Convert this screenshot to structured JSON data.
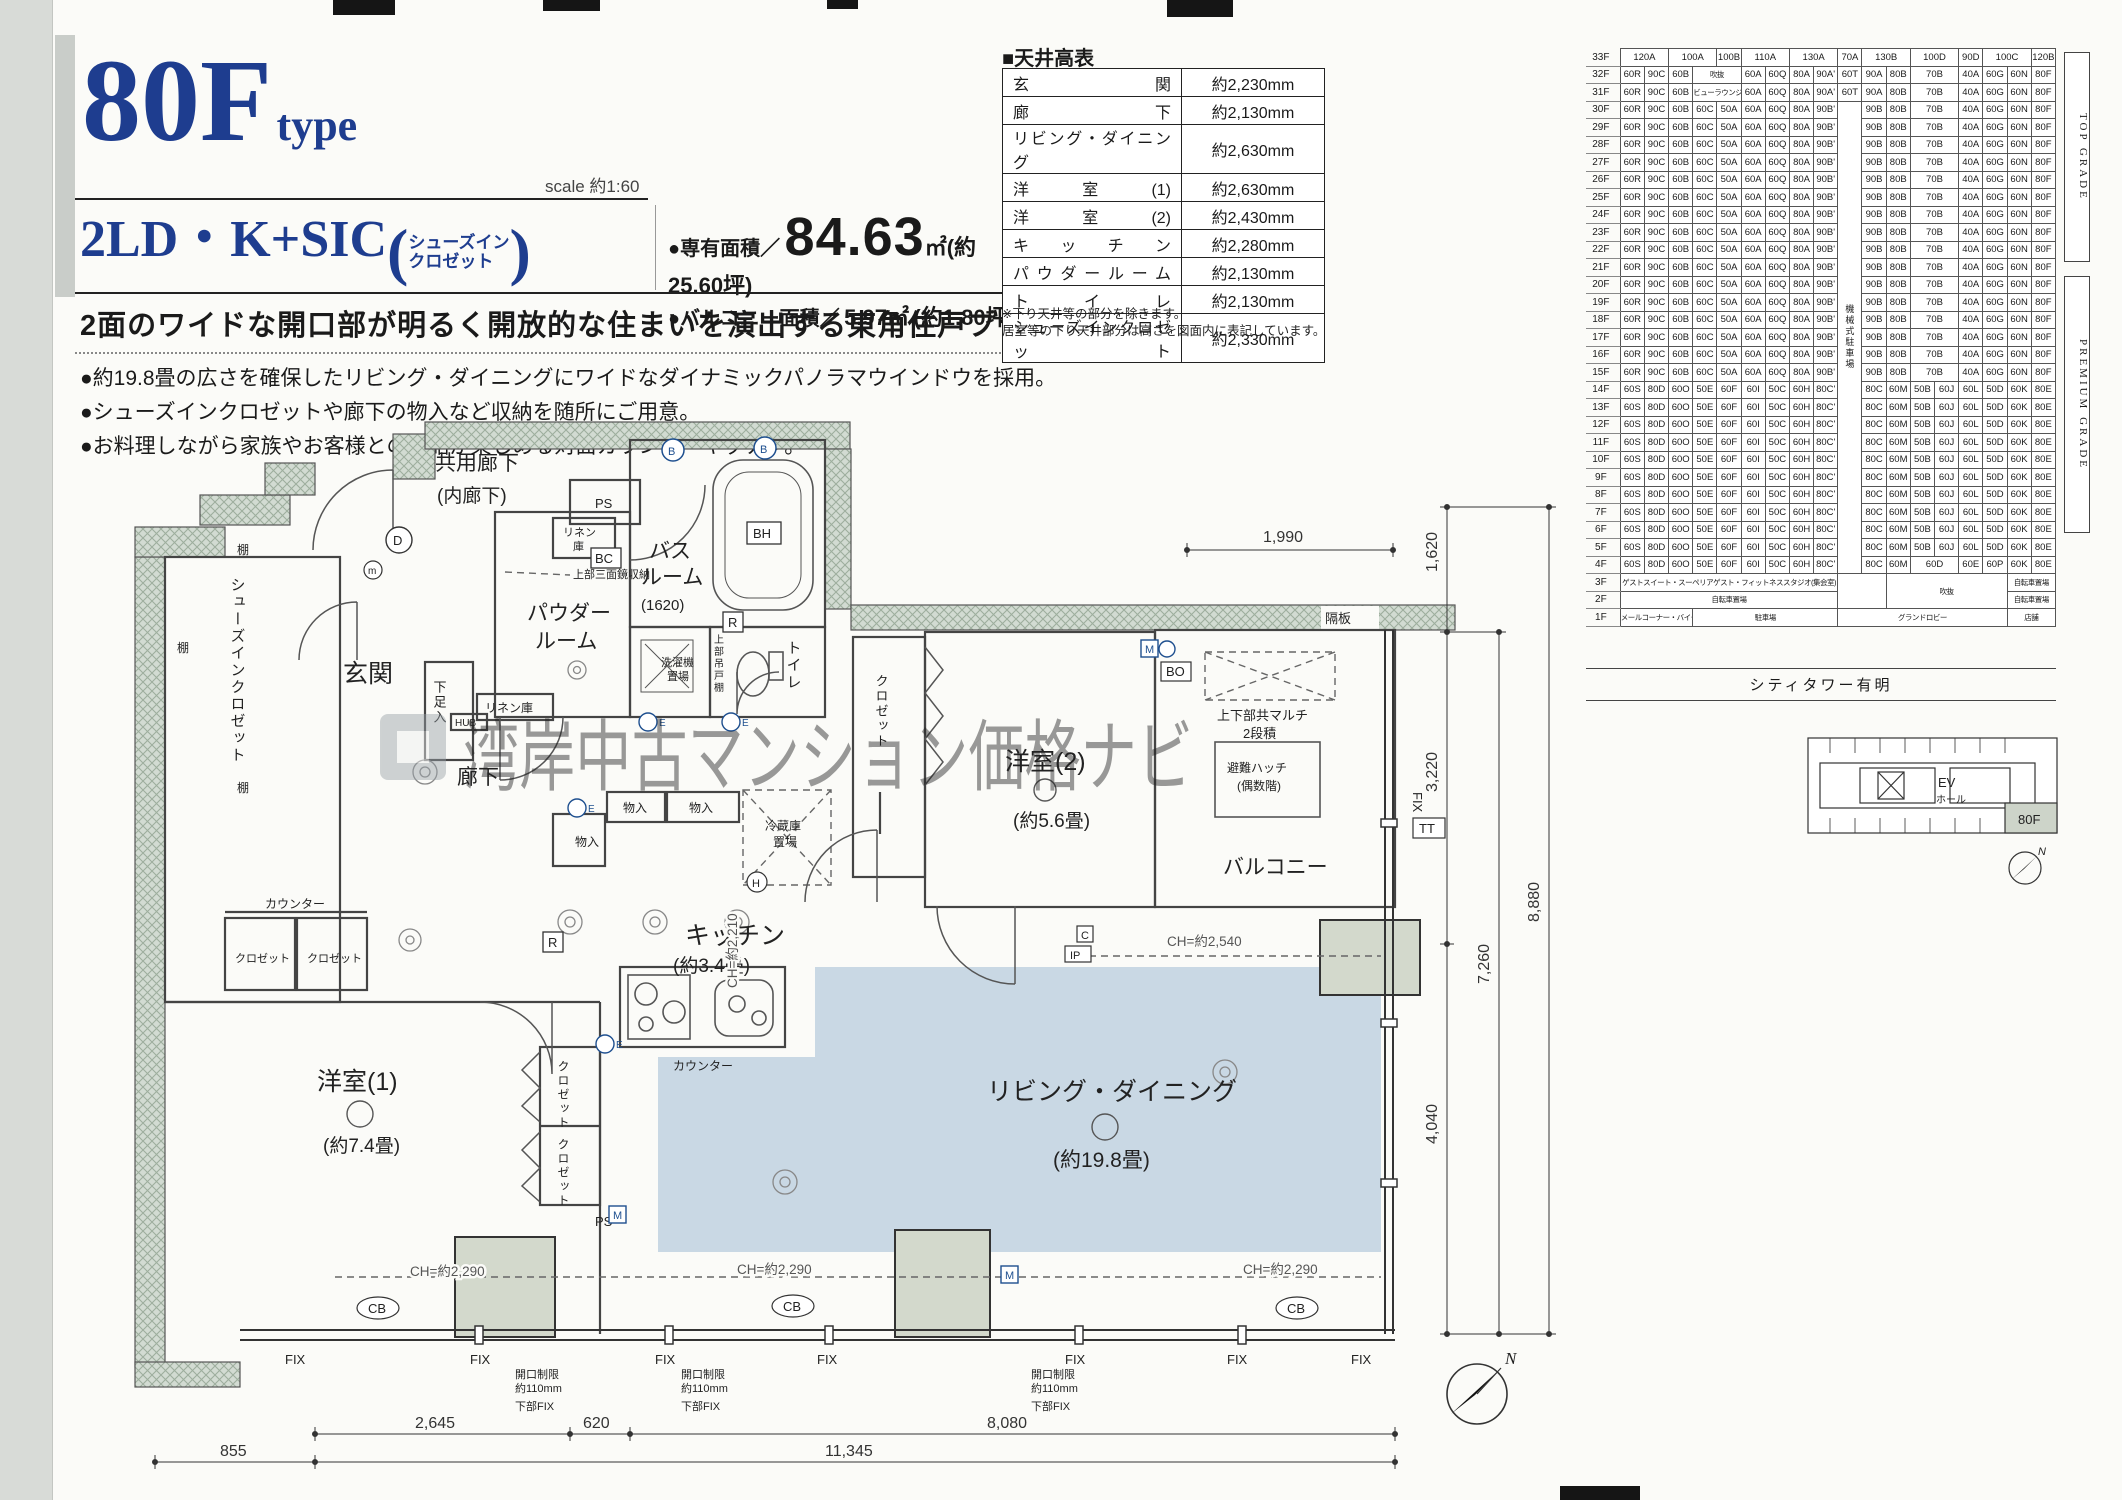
{
  "colors": {
    "brand_navy": "#1e3d8f",
    "plan_blue": "#c9d8e4",
    "hatch_green": "#d2dbd2",
    "pillar_gray": "#d3d9cc",
    "watermark_gray": "#97a0a6"
  },
  "header": {
    "type_code": "80F",
    "type_word": "type",
    "scale": "scale 約1:60",
    "layout_code": "2LD・K+SIC",
    "paren_open": "(",
    "paren_line1": "シューズイン",
    "paren_line2": "クロゼット",
    "paren_close": ")",
    "area1_label": "●専有面積／",
    "area1_value": "84.63",
    "area1_rest": "㎡(約25.60坪)",
    "area2_label": "●バルコニー面積／",
    "area2_value": "5.97㎡",
    "area2_rest": "(約1.80坪)",
    "headline": "2面のワイドな開口部が明るく開放的な住まいを演出する東角住戸プラン。",
    "bullets": [
      "●約19.8畳の広さを確保したリビング・ダイニングにワイドなダイナミックパノラマウインドウを採用。",
      "●シューズインクロゼットや廊下の物入など収納を随所にご用意。",
      "●お料理しながら家族やお客様との会話が楽しめる対面カウンターキッチン。"
    ]
  },
  "ceiling": {
    "title": "■天井高表",
    "rows": [
      {
        "name": "玄関",
        "value": "約2,230mm"
      },
      {
        "name": "廊下",
        "value": "約2,130mm"
      },
      {
        "name": "リビング・ダイニング",
        "value": "約2,630mm"
      },
      {
        "name": "洋室(1)",
        "value": "約2,630mm"
      },
      {
        "name": "洋室(2)",
        "value": "約2,430mm"
      },
      {
        "name": "キッチン",
        "value": "約2,280mm"
      },
      {
        "name": "パウダールーム",
        "value": "約2,130mm"
      },
      {
        "name": "トイレ",
        "value": "約2,130mm"
      },
      {
        "name": "シューズインクロゼット",
        "value": "約2,330mm"
      }
    ],
    "note1": "※下り天井等の部分を除きます。",
    "note2": "居室等の下り天井部分は高さを図面内に表記しています。"
  },
  "matrix": {
    "gap_label": "機械式駐車場",
    "gap_span": 27,
    "top_grade": "TOP GRADE",
    "premium_grade": "PREMIUM GRADE",
    "tower": "シティタワー有明",
    "templates": {
      "h": [
        {
          "t": "120A",
          "c": 2
        },
        {
          "t": "100A",
          "c": 2
        },
        {
          "t": "100B"
        },
        {
          "t": "110A",
          "c": 2
        },
        {
          "t": "130A",
          "c": 2
        },
        {
          "t": "70A"
        },
        {
          "t": "130B",
          "c": 2
        },
        {
          "t": "100D",
          "c": 2
        },
        {
          "t": "90D"
        },
        {
          "t": "100C",
          "c": 2
        },
        {
          "t": "120B"
        }
      ],
      "a32": [
        {
          "t": "60R"
        },
        {
          "t": "90C"
        },
        {
          "t": "60B"
        },
        {
          "t": "吹抜",
          "c": 2,
          "k": "s"
        },
        {
          "t": "60A"
        },
        {
          "t": "60Q"
        },
        {
          "t": "80A"
        },
        {
          "t": "90A'"
        },
        {
          "t": "60T"
        },
        {
          "t": "90A"
        },
        {
          "t": "80B"
        },
        {
          "t": "70B",
          "c": 2
        },
        {
          "t": "40A"
        },
        {
          "t": "60G"
        },
        {
          "t": "60N"
        },
        {
          "t": "80F"
        }
      ],
      "a31": [
        {
          "t": "60R"
        },
        {
          "t": "90C"
        },
        {
          "t": "60B"
        },
        {
          "t": "ビューラウンジ",
          "c": 2,
          "k": "s"
        },
        {
          "t": "60A"
        },
        {
          "t": "60Q"
        },
        {
          "t": "80A"
        },
        {
          "t": "90A'"
        },
        {
          "t": "60T"
        },
        {
          "t": "90A"
        },
        {
          "t": "80B"
        },
        {
          "t": "70B",
          "c": 2
        },
        {
          "t": "40A"
        },
        {
          "t": "60G"
        },
        {
          "t": "60N"
        },
        {
          "t": "80F"
        }
      ],
      "a": [
        {
          "t": "60R"
        },
        {
          "t": "90C"
        },
        {
          "t": "60B"
        },
        {
          "t": "60C"
        },
        {
          "t": "50A"
        },
        {
          "t": "60A"
        },
        {
          "t": "60Q"
        },
        {
          "t": "80A"
        },
        {
          "t": "90B'"
        },
        {
          "t": "90B"
        },
        {
          "t": "80B"
        },
        {
          "t": "70B",
          "c": 2
        },
        {
          "t": "40A"
        },
        {
          "t": "60G"
        },
        {
          "t": "60N"
        },
        {
          "t": "80F"
        }
      ],
      "b": [
        {
          "t": "60S"
        },
        {
          "t": "80D"
        },
        {
          "t": "60O"
        },
        {
          "t": "50E"
        },
        {
          "t": "60F"
        },
        {
          "t": "60I"
        },
        {
          "t": "50C"
        },
        {
          "t": "60H"
        },
        {
          "t": "80C'"
        },
        {
          "t": "80C"
        },
        {
          "t": "60M"
        },
        {
          "t": "50B"
        },
        {
          "t": "60J"
        },
        {
          "t": "60L"
        },
        {
          "t": "50D"
        },
        {
          "t": "60K"
        },
        {
          "t": "80E"
        }
      ],
      "b4": [
        {
          "t": "60S"
        },
        {
          "t": "80D"
        },
        {
          "t": "60O"
        },
        {
          "t": "50E"
        },
        {
          "t": "60F"
        },
        {
          "t": "60I"
        },
        {
          "t": "50C"
        },
        {
          "t": "60H"
        },
        {
          "t": "80C'"
        },
        {
          "t": "80C"
        },
        {
          "t": "60M"
        },
        {
          "t": "60D",
          "c": 2
        },
        {
          "t": "60E"
        },
        {
          "t": "60P"
        },
        {
          "t": "60K"
        },
        {
          "t": "80E"
        }
      ],
      "f3": [
        {
          "t": "ゲストスイート・スーペリアゲスト・フィットネススタジオ(集会室)",
          "c": 9,
          "k": "s"
        },
        {
          "t": "",
          "c": 2,
          "r": 2
        },
        {
          "t": "吹抜",
          "c": 5,
          "r": 2,
          "k": "s"
        },
        {
          "t": "自転車置場",
          "c": 2,
          "k": "s"
        }
      ],
      "f2": [
        {
          "t": "自転車置場",
          "c": 9,
          "k": "s"
        },
        {
          "t": "自転車置場",
          "c": 2,
          "k": "s"
        }
      ],
      "f1": [
        {
          "t": "メールコーナー・バイク置場",
          "c": 3,
          "k": "s"
        },
        {
          "t": "駐車場",
          "c": 6,
          "k": "s"
        },
        {
          "t": "グランドロビー",
          "c": 7,
          "k": "s"
        },
        {
          "t": "店舗",
          "c": 2,
          "k": "s"
        }
      ]
    },
    "rows": [
      {
        "f": "33F",
        "tpl": "h"
      },
      {
        "f": "32F",
        "tpl": "a32"
      },
      {
        "f": "31F",
        "tpl": "a31"
      },
      {
        "f": "30F",
        "tpl": "a",
        "g": 1
      },
      {
        "f": "29F",
        "tpl": "a"
      },
      {
        "f": "28F",
        "tpl": "a"
      },
      {
        "f": "27F",
        "tpl": "a"
      },
      {
        "f": "26F",
        "tpl": "a"
      },
      {
        "f": "25F",
        "tpl": "a"
      },
      {
        "f": "24F",
        "tpl": "a"
      },
      {
        "f": "23F",
        "tpl": "a"
      },
      {
        "f": "22F",
        "tpl": "a"
      },
      {
        "f": "21F",
        "tpl": "a"
      },
      {
        "f": "20F",
        "tpl": "a"
      },
      {
        "f": "19F",
        "tpl": "a"
      },
      {
        "f": "18F",
        "tpl": "a"
      },
      {
        "f": "17F",
        "tpl": "a"
      },
      {
        "f": "16F",
        "tpl": "a"
      },
      {
        "f": "15F",
        "tpl": "a"
      },
      {
        "f": "14F",
        "tpl": "b"
      },
      {
        "f": "13F",
        "tpl": "b"
      },
      {
        "f": "12F",
        "tpl": "b"
      },
      {
        "f": "11F",
        "tpl": "b"
      },
      {
        "f": "10F",
        "tpl": "b"
      },
      {
        "f": "9F",
        "tpl": "b"
      },
      {
        "f": "8F",
        "tpl": "b"
      },
      {
        "f": "7F",
        "tpl": "b"
      },
      {
        "f": "6F",
        "tpl": "b"
      },
      {
        "f": "5F",
        "tpl": "b"
      },
      {
        "f": "4F",
        "tpl": "b4"
      },
      {
        "f": "3F",
        "tpl": "f3"
      },
      {
        "f": "2F",
        "tpl": "f2"
      },
      {
        "f": "1F",
        "tpl": "f1"
      }
    ]
  },
  "keyplan": {
    "ev": "EV",
    "hall": "ホール",
    "unit": "80F",
    "north": "N"
  },
  "plan": {
    "watermark": "湾岸中古マンション価格ナビ",
    "rooms": {
      "kyoyo": "共用廊下",
      "kyoyo2": "(内廊下)",
      "sic": "シューズインクロゼット",
      "genkan": "玄関",
      "roka": "廊下",
      "powder1": "パウダー",
      "powder2": "ルーム",
      "bath1": "バス",
      "bath2": "ルーム",
      "bath3": "(1620)",
      "wc": "トイレ",
      "laundry1": "洗濯機",
      "laundry2": "置場",
      "kitchen": "キッチン",
      "kitchen_s": "(約3.4畳)",
      "living": "リビング・ダイニング",
      "living_s": "(約19.8畳)",
      "yo1": "洋室(1)",
      "yo1_s": "(約7.4畳)",
      "yo2": "洋室(2)",
      "yo2_s": "(約5.6畳)",
      "balcony": "バルコニー",
      "closet": "クロゼット",
      "monoire": "物入",
      "reizo1": "冷蔵庫",
      "reizo2": "置場",
      "gesoku": "下足入",
      "counter": "カウンター",
      "tana": "棚",
      "linen1": "リネン",
      "linen2": "庫",
      "linen": "リネン庫",
      "tsuri": "上部吊戸棚",
      "mirror": "上部三面鏡収納",
      "multi1": "上下部共マルチ",
      "multi2": "2段積",
      "hinan1": "避難ハッチ",
      "hinan2": "(偶数階)",
      "kakuita": "隔板"
    },
    "markers": {
      "d": "D",
      "m_lo": "m",
      "b": "B",
      "bh": "BH",
      "r": "R",
      "bc": "BC",
      "hub": "HUB",
      "e": "E",
      "h": "H",
      "c": "C",
      "ip": "IP",
      "m": "M",
      "tt": "TT",
      "bo": "BO",
      "cb": "CB",
      "ps": "PS",
      "fix": "FIX",
      "north": "N"
    },
    "ch": {
      "c2540": "CH=約2,540",
      "c2290": "CH=約2,290",
      "c2210": "CH=約2,210"
    },
    "restrict": {
      "l1": "開口制限",
      "l2": "約110mm",
      "l3": "下部FIX"
    },
    "dims": {
      "w1990": "1,990",
      "h1620": "1,620",
      "h3220": "3,220",
      "h7260": "7,260",
      "h8880": "8,880",
      "h4040": "4,040",
      "w855": "855",
      "w2645": "2,645",
      "w620": "620",
      "w11345": "11,345",
      "w8080": "8,080"
    }
  }
}
